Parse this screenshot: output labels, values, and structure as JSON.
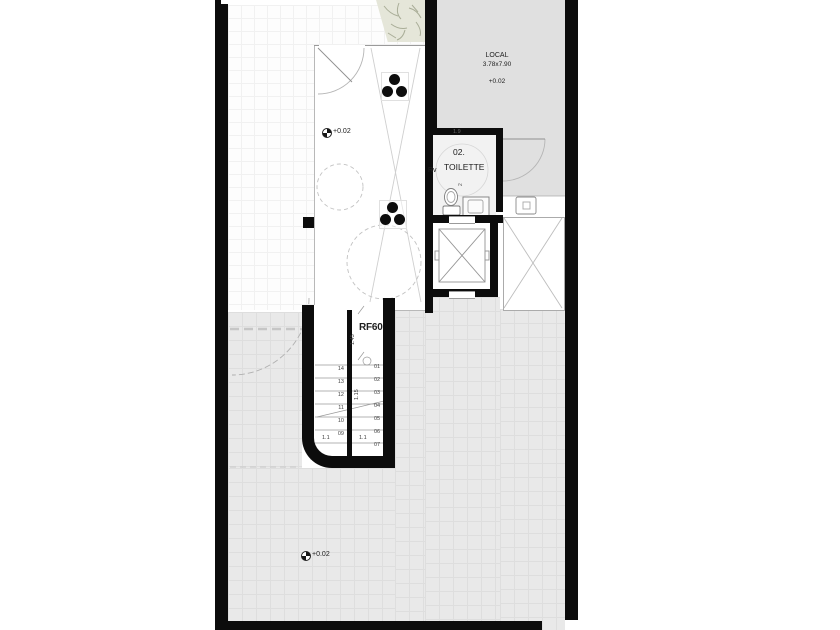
{
  "drawing": {
    "type": "architectural floor plan, ground level",
    "colors": {
      "wall": "#0c0c0c",
      "room_gray": "#e0e0e0",
      "tile_gray": "#e9e9e9",
      "planter_green": "#e5e6d9"
    }
  },
  "rooms": {
    "local": {
      "name": "LOCAL",
      "size": "3.78x7.90",
      "level": "+0.02"
    },
    "toilette": {
      "number": "02.",
      "name": "TOILETTE",
      "side_label": "Rv",
      "door_dim": "1.9",
      "area_note": "2"
    },
    "hall": {
      "level": "+0.02"
    },
    "terrace": {
      "level": "+0.02"
    }
  },
  "stairs": {
    "label": "RF60",
    "dim_top": "1.45",
    "dim_mid": "1.15",
    "dim_left_flight": "1.1",
    "dim_right_flight": "1.1",
    "left_steps": [
      "14",
      "13",
      "12",
      "11",
      "10",
      "09"
    ],
    "right_steps": [
      "01",
      "02",
      "03",
      "04",
      "05",
      "06",
      "07"
    ]
  }
}
